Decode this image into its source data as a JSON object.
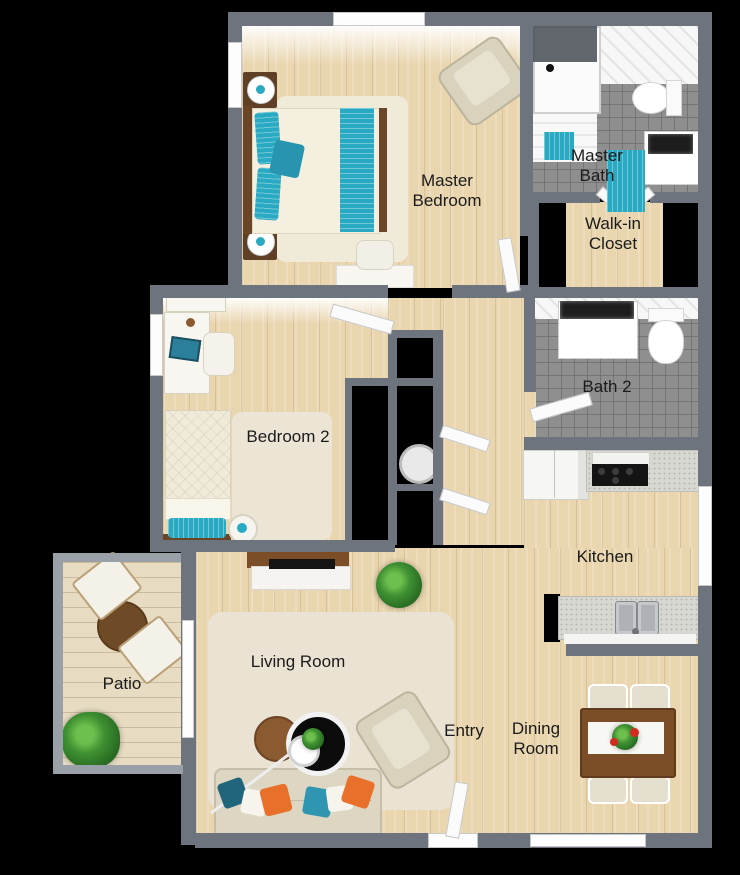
{
  "palette": {
    "wall": "#6e747d",
    "wood": "#e9d5ae",
    "deck": "#e7dcc2",
    "tile": "#8f8f8f",
    "teal": "#29a9c2",
    "dark_teal": "#20657c",
    "orange": "#e8702a",
    "sofa_beige": "#ddd6c2",
    "table_brown": "#7b4e28",
    "rug_beige": "#eae3d4",
    "label": "#1b1b1b",
    "background": "#000000"
  },
  "rooms": {
    "master_bedroom": {
      "label": "Master\nBedroom"
    },
    "master_bath": {
      "label": "Master\nBath"
    },
    "walk_in_closet": {
      "label": "Walk-in\nCloset"
    },
    "bath_2": {
      "label": "Bath 2"
    },
    "bedroom_2": {
      "label": "Bedroom 2"
    },
    "kitchen": {
      "label": "Kitchen"
    },
    "living_room": {
      "label": "Living Room"
    },
    "patio": {
      "label": "Patio"
    },
    "entry": {
      "label": "Entry"
    },
    "dining_room": {
      "label": "Dining\nRoom"
    }
  }
}
